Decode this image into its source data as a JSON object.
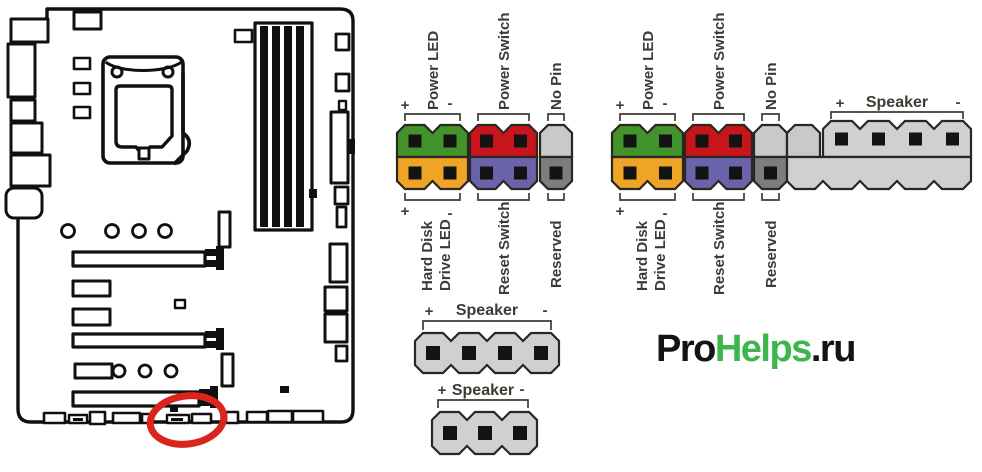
{
  "labels": {
    "power_led": "Power LED",
    "power_switch": "Power Switch",
    "no_pin": "No Pin",
    "hdd_line1": "Hard Disk",
    "hdd_line2": "Drive LED",
    "reset_switch": "Reset Switch",
    "reserved": "Reserved",
    "speaker": "Speaker",
    "plus": "+",
    "minus": "-"
  },
  "colors": {
    "power_led": "#42932c",
    "hdd_led": "#eea426",
    "power_switch": "#c8141b",
    "reset_switch": "#6a62ab",
    "no_pin_light": "#c9c9c9",
    "reserved_dark": "#7d7d7d",
    "speaker_gray": "#d0d0d0",
    "pin_outline": "#2b2620",
    "pin_hole": "#131313",
    "label_text": "#3f3a34",
    "highlight": "#d9251c",
    "board_line": "#101010",
    "logo_dark": "#141414",
    "logo_green": "#3cb54b"
  },
  "logo": {
    "part1": "Pro",
    "part2": "Helps",
    "part3": ".ru"
  }
}
